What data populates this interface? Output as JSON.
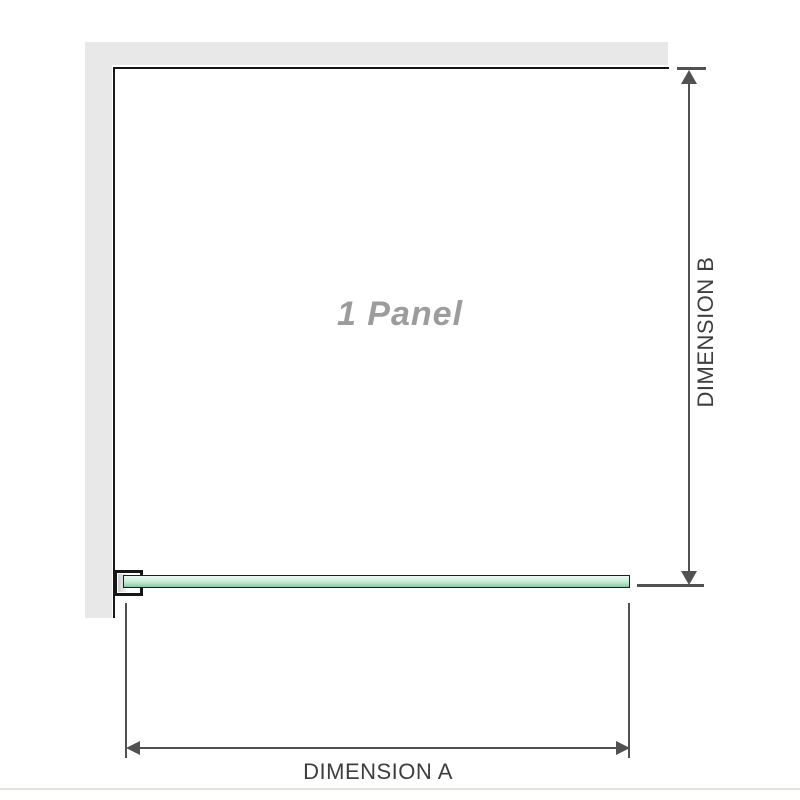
{
  "labels": {
    "panel": "1 Panel",
    "dimension_a": "DIMENSION A",
    "dimension_b": "DIMENSION B"
  },
  "colors": {
    "wall": "#e8e8e8",
    "outline": "#161616",
    "dimension": "#515151",
    "label_text": "#3e3e3e",
    "panel_text": "#9c9c9c",
    "glass_top": "#ebf8f1",
    "glass_mid": "#cdeeda",
    "glass_bottom": "#82c99e",
    "baseline": "#e4e1da"
  }
}
